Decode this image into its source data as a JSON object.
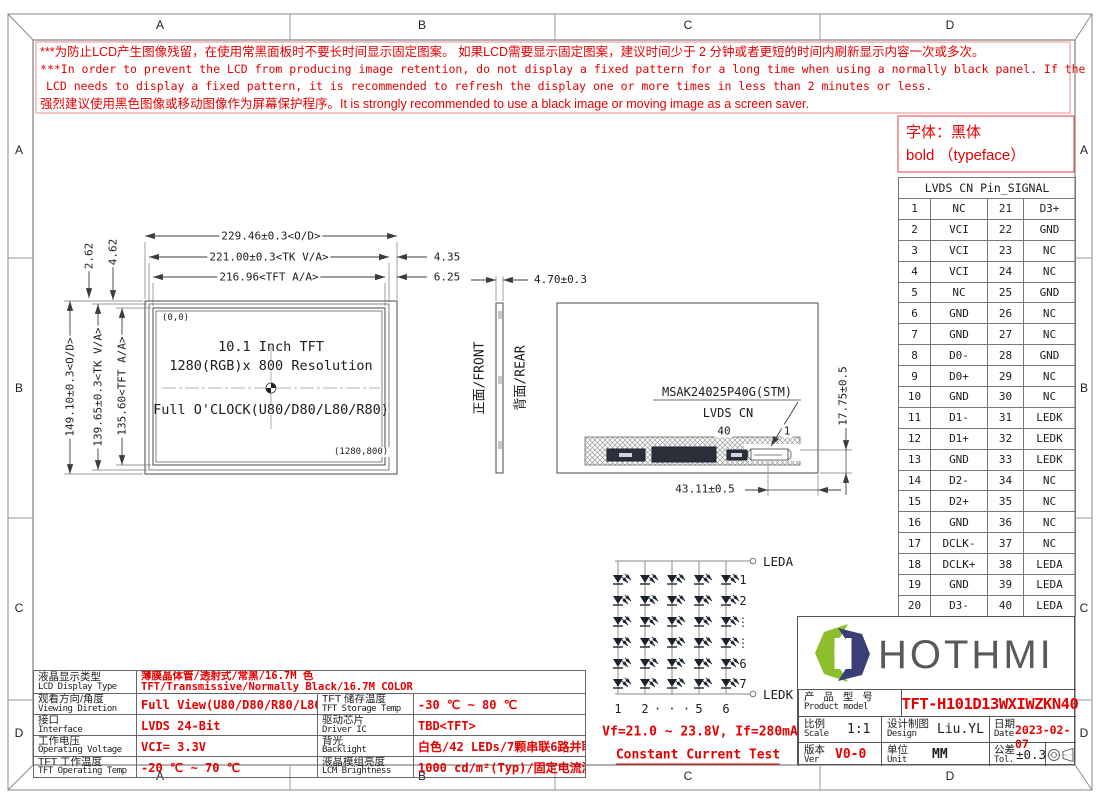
{
  "frame": {
    "cols": [
      "A",
      "B",
      "C",
      "D"
    ],
    "rows": [
      "A",
      "B",
      "C",
      "D"
    ]
  },
  "warning": {
    "line1": "***为防止LCD产生图像残留，在使用常黑面板时不要长时间显示固定图案。 如果LCD需要显示固定图案，建议时间少于 2 分钟或者更短的时间内刷新显示内容一次或多次。",
    "line2": "***In order to prevent the LCD from producing image retention, do not display a fixed pattern for a long time when using a normally black panel. If the",
    "line3": "LCD needs to display a fixed pattern, it is recommended to refresh the display one or more times in less than 2 minutes or less.",
    "line4": "强烈建议使用黑色图像或移动图像作为屏幕保护程序。It is strongly recommended to use a black image or moving image as a screen saver."
  },
  "typeface_note": {
    "line1": "字体：黑体",
    "line2": "bold （typeface）"
  },
  "pin_table": {
    "header": "LVDS CN Pin_SIGNAL",
    "rows": [
      [
        "1",
        "NC",
        "21",
        "D3+"
      ],
      [
        "2",
        "VCI",
        "22",
        "GND"
      ],
      [
        "3",
        "VCI",
        "23",
        "NC"
      ],
      [
        "4",
        "VCI",
        "24",
        "NC"
      ],
      [
        "5",
        "NC",
        "25",
        "GND"
      ],
      [
        "6",
        "GND",
        "26",
        "NC"
      ],
      [
        "7",
        "GND",
        "27",
        "NC"
      ],
      [
        "8",
        "D0-",
        "28",
        "GND"
      ],
      [
        "9",
        "D0+",
        "29",
        "NC"
      ],
      [
        "10",
        "GND",
        "30",
        "NC"
      ],
      [
        "11",
        "D1-",
        "31",
        "LEDK"
      ],
      [
        "12",
        "D1+",
        "32",
        "LEDK"
      ],
      [
        "13",
        "GND",
        "33",
        "LEDK"
      ],
      [
        "14",
        "D2-",
        "34",
        "NC"
      ],
      [
        "15",
        "D2+",
        "35",
        "NC"
      ],
      [
        "16",
        "GND",
        "36",
        "NC"
      ],
      [
        "17",
        "DCLK-",
        "37",
        "NC"
      ],
      [
        "18",
        "DCLK+",
        "38",
        "LEDA"
      ],
      [
        "19",
        "GND",
        "39",
        "LEDA"
      ],
      [
        "20",
        "D3-",
        "40",
        "LEDA"
      ]
    ]
  },
  "front_view": {
    "origin_label": "(0,0)",
    "end_label": "(1280,800)",
    "line1": "10.1 Inch TFT",
    "line2": "1280(RGB)x 800 Resolution",
    "line3": "Full O'CLOCK(U80/D80/L80/R80)",
    "dims": {
      "od_w": "229.46±0.3<O/D>",
      "tk_w": "221.00±0.3<TK V/A>",
      "aa_w": "216.96<TFT A/A>",
      "right1": "4.35",
      "right2": "6.25",
      "od_h": "149.10±0.3<O/D>",
      "tk_h": "139.65±0.3<TK V/A>",
      "aa_h": "135.60<TFT A/A>",
      "gap1": "2.62",
      "gap2": "4.62"
    }
  },
  "side_view": {
    "thickness": "4.70±0.3",
    "front_label": "正面/FRONT",
    "rear_label": "背面/REAR"
  },
  "rear_view": {
    "connector_model": "MSAK24025P40G(STM)",
    "connector_name": "LVDS CN",
    "pin40": "40",
    "pin1": "1",
    "dim_width": "43.11±0.5",
    "dim_height": "17.75±0.5"
  },
  "led_circuit": {
    "anode": "LEDA",
    "cathode": "LEDK",
    "row_labels": [
      "1",
      "2",
      "⋮",
      "⋮",
      "6",
      "7"
    ],
    "col_labels": [
      "1",
      "2",
      "· · ·",
      "5",
      "6"
    ],
    "vf_text": "Vf=21.0 ~ 23.8V, If=280mA",
    "test_text": "Constant Current Test"
  },
  "spec_table": {
    "rows": [
      {
        "label_cn": "液晶显示类型",
        "label_en": "LCD Display Type",
        "span": true,
        "value": "薄膜晶体管/透射式/常黑/16.7M 色",
        "value_line2": "TFT/Transmissive/Normally Black/16.7M COLOR"
      },
      {
        "label_cn": "观看方向/角度",
        "label_en": "Viewing Diretion",
        "value": "Full View(U80/D80/R80/L80)",
        "label2_cn": "TFT 储存温度",
        "label2_en": "TFT Storage Temp",
        "value2": "-30 ℃ ~ 80 ℃"
      },
      {
        "label_cn": "接口",
        "label_en": "Interface",
        "value": "LVDS 24-Bit",
        "label2_cn": "驱动芯片",
        "label2_en": "Driver IC",
        "value2": "TBD<TFT>"
      },
      {
        "label_cn": "工作电压",
        "label_en": "Operating Voltage",
        "value": "VCI= 3.3V",
        "label2_cn": "背光",
        "label2_en": "Backlight",
        "value2": "白色/42 LEDs/7颗串联6路并联"
      },
      {
        "label_cn": "TFT 工作温度",
        "label_en": "TFT Operating Temp",
        "value": "-20 ℃ ~ 70 ℃",
        "label2_cn": "液晶模组亮度",
        "label2_en": "LCM Brightness",
        "value2": "1000 cd/m²(Typ)/固定电流测试"
      }
    ]
  },
  "title_block": {
    "brand": "HOTHMI",
    "product_label_cn": "产 品 型 号",
    "product_label_en": "Product model",
    "product_model": "TFT-H101D13WXIWZKN40",
    "scale_label_cn": "比例",
    "scale_label_en": "Scale",
    "scale": "1:1",
    "design_label_cn": "设计制图",
    "design_label_en": "Design",
    "designer": "Liu.YL",
    "date_label_cn": "日期",
    "date_label_en": "Date",
    "date": "2023-02-07",
    "ver_label_cn": "版本",
    "ver_label_en": "Ver",
    "version": "V0-0",
    "unit_label_cn": "单位",
    "unit_label_en": "Unit",
    "unit": "MM",
    "tol_label_cn": "公差",
    "tol_label_en": "Tol.",
    "tolerance": "±0.3",
    "colors": {
      "logo_green": "#8dbe2c",
      "logo_navy": "#3a3f76",
      "accent_red": "#e60000"
    }
  }
}
